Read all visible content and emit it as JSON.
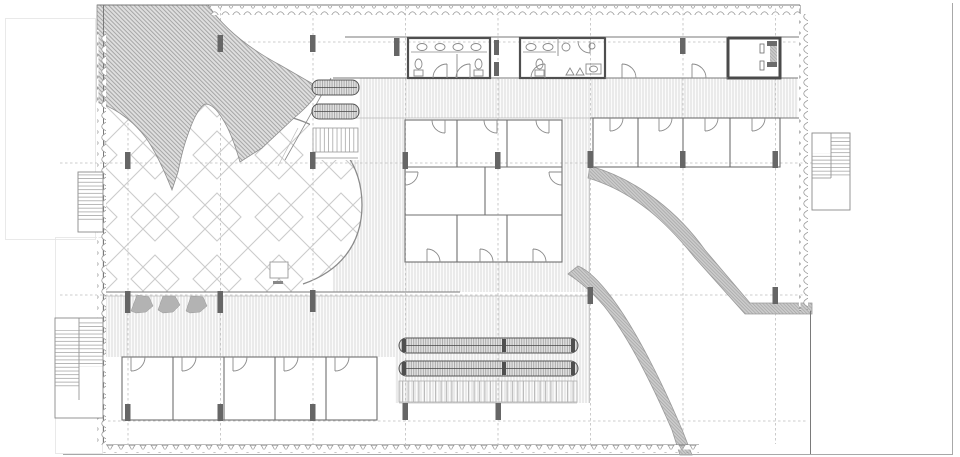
{
  "meta": {
    "title": "architectural-ground-floor-plan",
    "description": "Black-and-white architectural floor plan: hatched rock outcrop at top-left, courtyard with diamond paving, central block of eight guest rooms, four rooms top-right, five rooms bottom-left, two restrooms and an elevator core along the top, slatted timber decks, two long louvered tables, curved hatched ramps exiting bottom-right, and external staircases on the left and right edges.",
    "text_labels": []
  },
  "canvas": {
    "width": 960,
    "height": 457,
    "background": "#ffffff"
  },
  "colors": {
    "background": "#ffffff",
    "wall_line": "#7a7a7a",
    "light_line": "#b5b5b5",
    "grid_dash": "#bdbdbd",
    "slat_line": "#c9c9c9",
    "rock_fill": "#dedede",
    "rock_hatch_line": "#8f8f8f",
    "ramp_fill": "#cbcbcb",
    "ramp_hatch_line": "#9e9e9e",
    "stone_line": "#9a9a9a",
    "diamond_line": "#cccccc",
    "column": "#666666",
    "tree": "#b3b3b3",
    "fixture_line": "#8a8a8a",
    "dark_wall": "#4f4f4f"
  },
  "inventory": {
    "guest_rooms_center_block": 8,
    "guest_rooms_top_right": 4,
    "guest_rooms_bottom_row": 5,
    "restrooms": 2,
    "elevator_cores": 1,
    "external_staircases": 3,
    "internal_stairs": 1,
    "curved_ramps": 2,
    "long_tables": 2,
    "trees": 3,
    "structural_columns": 22,
    "door_swings": 24,
    "sinks": 7,
    "toilets": 3
  }
}
